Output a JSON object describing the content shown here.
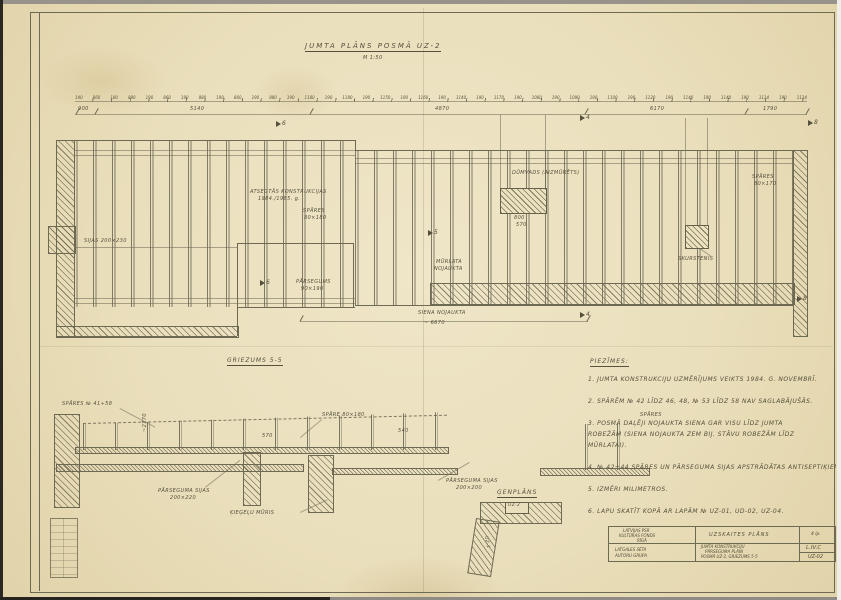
{
  "sheet": {
    "title": "JUMTA PLĀNS POSMĀ UZ-2",
    "scale": "M 1:50"
  },
  "dims": {
    "chain": [
      "140",
      "860",
      "190",
      "890",
      "190",
      "860",
      "190",
      "880",
      "190",
      "860",
      "190",
      "880",
      "190",
      "1180",
      "190",
      "1180",
      "190",
      "1150",
      "190",
      "1160",
      "190",
      "1140",
      "190",
      "1170",
      "190",
      "1080",
      "190",
      "1090",
      "190",
      "1100",
      "190",
      "1120",
      "190",
      "1140",
      "190",
      "1140",
      "190",
      "1114",
      "190",
      "1124"
    ],
    "segments": [
      "900",
      "5140",
      "4870",
      "6170",
      "1790"
    ],
    "plan_bottom": "~ 6670",
    "chimney1_w": "800",
    "chimney1_h": "570"
  },
  "markers": {
    "m4": "4",
    "m5": "5",
    "m6": "6",
    "m8": "8"
  },
  "plan_labels": {
    "atsegums_1": "ATSEGTĀS KONSTRUKCIJAS",
    "atsegums_2": "1984./1985. g.",
    "spares_1": "SPĀRES",
    "spares_1_dim": "80×180",
    "sijas": "SIJAS 200×230",
    "parsegums": "PĀRSEGUMS",
    "parsegums_dim": "90×190",
    "murlata": "MŪRLATA",
    "murlata_state": "NOJAUKTA",
    "siena": "SIENA NOJAUKTA",
    "dumvads": "DŪMVADS (AIZMŪRĒTS)",
    "spares_2": "SPĀRES",
    "spares_2_dim": "80×170",
    "skurstenis": "SKURSTENIS"
  },
  "section": {
    "title": "GRIEZUMS 5-5",
    "labels": {
      "spares_left": "SPĀRES № 41÷58",
      "spare_mid": "SPĀRE 80×180",
      "dim_570": "570",
      "dim_540": "540",
      "dim_2770": "~2770",
      "sijas_left": "PĀRSEGUMA SIJAS",
      "sijas_left_dim": "200×220",
      "sijas_right": "PĀRSEGUMA SIJAS",
      "sijas_right_dim": "200×200",
      "muris": "ĶIEĢEĻU MŪRIS",
      "spares_right": "SPĀRES"
    }
  },
  "genplans": {
    "title": "ĢENPLĀNS",
    "uz2": "UZ-2",
    "uz1": "UZ-1"
  },
  "notes": {
    "title": "PIEZĪMES:",
    "lines": [
      "1. JUMTA KONSTRUKCIJU UZMĒRĪJUMS VEIKTS 1984. G. NOVEMBRĪ.",
      "",
      "2. SPĀRĒM № 42 LĪDZ 46, 48, № 53 LĪDZ 58 NAV SAGLABĀJUŠĀS.",
      "",
      "3. POSMĀ DAĻĒJI NOJAUKTA SIENA GAR VISU LĪDZ JUMTA",
      "ROBEŽĀM (SIENA NOJAUKTA ZEM BIJ. STĀVU ROBEŽĀM LĪDZ",
      "MŪRLATAI).",
      "",
      "4. № 42÷44 SPĀRES UN PĀRSEGUMA SIJAS APSTRĀDĀTAS ANTISEPTIĶIEM.",
      "",
      "5. IZMĒRI MILIMETROS.",
      "",
      "6. LAPU SKATĪT KOPĀ AR LAPĀM № UZ-01, UD-02, UZ-04."
    ]
  },
  "titleblock": {
    "org_1": "LATVIJAS PSR",
    "org_2": "KULTŪRAS FONDS",
    "org_3": "RĪGĀ",
    "doc_type": "UZSKAITES PLĀNS",
    "sheet_count": "4 lp.",
    "object_1": "LATGALES SĒTA",
    "object_2": "AUTORU GRUPA",
    "title_1": "JUMTA KONSTRUKCIJU",
    "title_2": "PĀRSEGUMA PLĀNI",
    "title_3": "POSMĀ UZ-2, GRIEZUMS 5-5",
    "code_top": "L.IV.C",
    "code_bottom": "UZ-02"
  },
  "colors": {
    "paper": "#eadfbc",
    "line": "#6e6952",
    "ink": "#55503c"
  }
}
